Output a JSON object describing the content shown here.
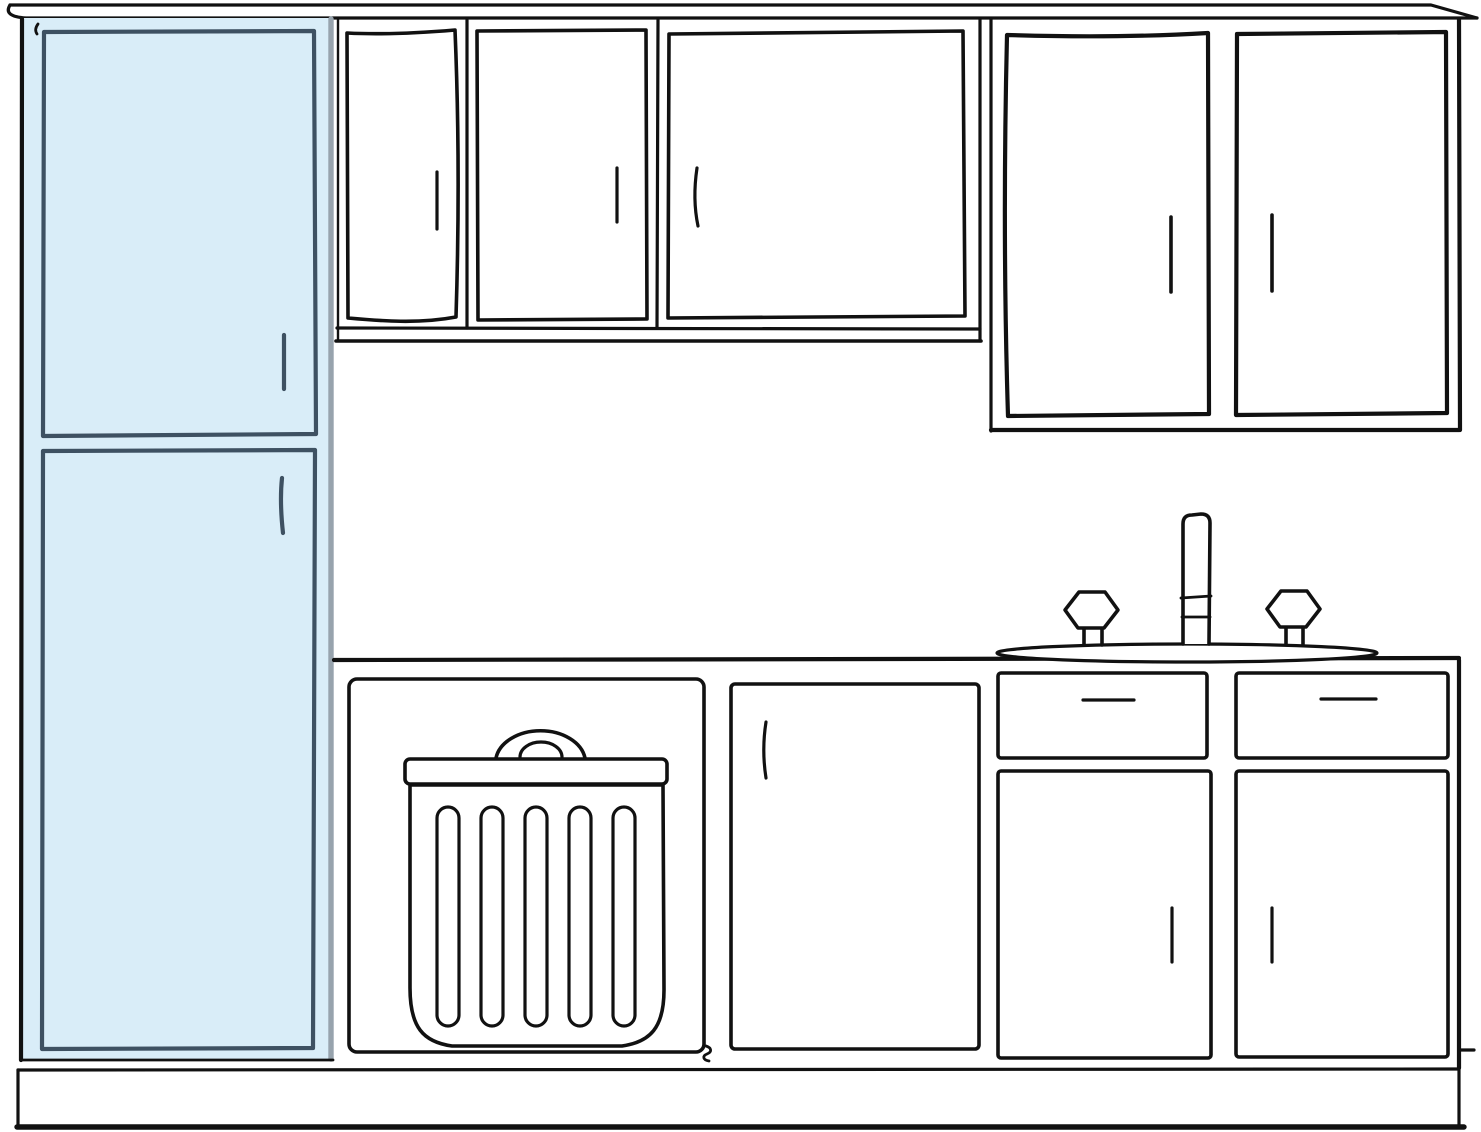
{
  "canvas": {
    "width": 1481,
    "height": 1132,
    "background": "#ffffff"
  },
  "colors": {
    "ink": "#111111",
    "highlight_fill": "#d9edf8",
    "highlight_stroke": "#3e5162",
    "side_panel_gray": "#97a3ad",
    "paper": "#ffffff"
  },
  "scene": {
    "description": "Hand-drawn kitchen cabinet elevation sketch",
    "highlighted_component": "tall-cabinet",
    "components": [
      {
        "id": "crown-molding",
        "kind": "trim"
      },
      {
        "id": "tall-cabinet",
        "kind": "tall cabinet",
        "doors": 2,
        "highlighted": true
      },
      {
        "id": "upper-cabinet-left",
        "kind": "wall cabinet",
        "doors": 3
      },
      {
        "id": "upper-cabinet-right",
        "kind": "wall cabinet",
        "doors": 2
      },
      {
        "id": "countertop",
        "kind": "counter"
      },
      {
        "id": "sink-faucet",
        "kind": "faucet with two knobs on sink deck"
      },
      {
        "id": "trash-cabinet",
        "kind": "base cabinet with trash-can icon"
      },
      {
        "id": "base-door-cabinet",
        "kind": "base cabinet",
        "doors": 1
      },
      {
        "id": "sink-base-cabinet",
        "kind": "sink base cabinet",
        "drawers": 2,
        "doors": 2
      },
      {
        "id": "toe-kick",
        "kind": "toe kick / floor line"
      }
    ]
  }
}
